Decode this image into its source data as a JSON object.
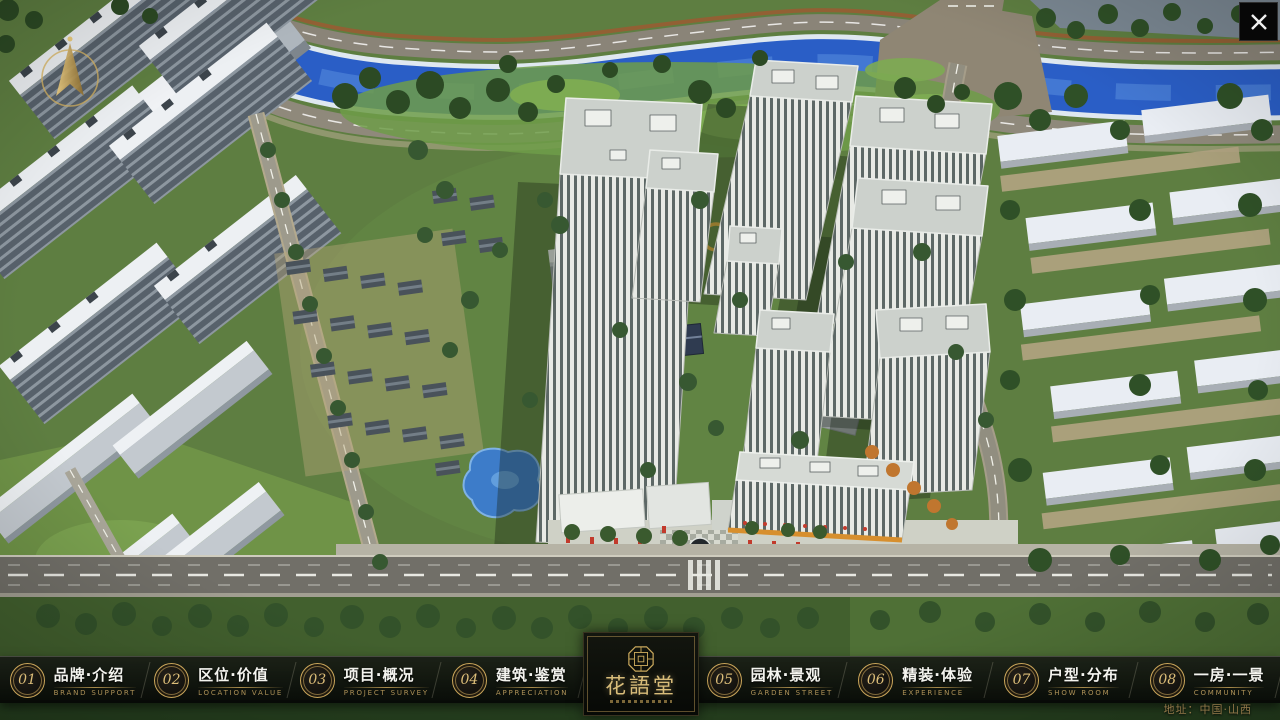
{
  "nav": {
    "items": [
      {
        "num": "01",
        "zh": "品牌·介绍",
        "en": "BRAND SUPPORT"
      },
      {
        "num": "02",
        "zh": "区位·价值",
        "en": "LOCATION VALUE"
      },
      {
        "num": "03",
        "zh": "项目·概况",
        "en": "PROJECT SURVEY"
      },
      {
        "num": "04",
        "zh": "建筑·鉴赏",
        "en": "APPRECIATION"
      },
      {
        "num": "05",
        "zh": "园林·景观",
        "en": "GARDEN STREET"
      },
      {
        "num": "06",
        "zh": "精装·体验",
        "en": "EXPERIENCE"
      },
      {
        "num": "07",
        "zh": "户型·分布",
        "en": "SHOW ROOM"
      },
      {
        "num": "08",
        "zh": "一房·一景",
        "en": "COMMUNITY"
      }
    ]
  },
  "logo": {
    "title": "花語堂"
  },
  "footer": {
    "address": "地址：中国·山西"
  },
  "icons": {
    "close": "x-cross",
    "compass": "north-arrow",
    "seal": "octagon-seal"
  },
  "colors": {
    "accent_gold": "#c9a55a",
    "bar_background": "#0a0c09",
    "river_blue": "#2a5ec6",
    "lawn_green": "#6f9c49",
    "tree_green": "#2c4a24",
    "tower_white": "#e8eae5"
  }
}
